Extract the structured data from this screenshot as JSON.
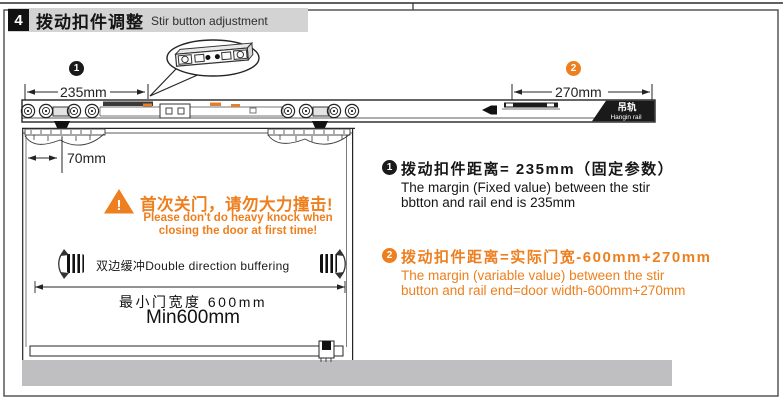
{
  "header": {
    "step": "4",
    "title_zh": "拨动扣件调整",
    "title_en": "Stir button adjustment"
  },
  "diagram": {
    "marker1": "1",
    "marker2": "2",
    "dim_rail_left": "235mm",
    "dim_rail_right": "270mm",
    "dim_door": "70mm",
    "rail_label_zh": "吊轨",
    "rail_label_en": "Hangin rail",
    "warning_mark": "!",
    "warning_zh": "首次关门，请勿大力撞击!",
    "warning_en1": "Please don't do heavy knock when",
    "warning_en2": "closing the door at first time!",
    "buffering_label": "双边缓冲Double direction buffering",
    "min_width_zh": "最小门宽度 600mm",
    "min_width_en": "Min600mm"
  },
  "notes": [
    {
      "marker": "1",
      "zh": "拨动扣件距离= 235mm（固定参数）",
      "en_line1": "The margin (Fixed value) between the stir",
      "en_line2": "bbtton and rail end is 235mm"
    },
    {
      "marker": "2",
      "zh": "拨动扣件距离=实际门宽-600mm+270mm",
      "en_line1": "The margin (variable value) between the stir",
      "en_line2": "button and rail end=door width-600mm+270mm"
    }
  ],
  "colors": {
    "accent_orange": "#EE7F1E",
    "floor_gray": "#BFBFC2",
    "header_gray": "#D3D3D3"
  }
}
